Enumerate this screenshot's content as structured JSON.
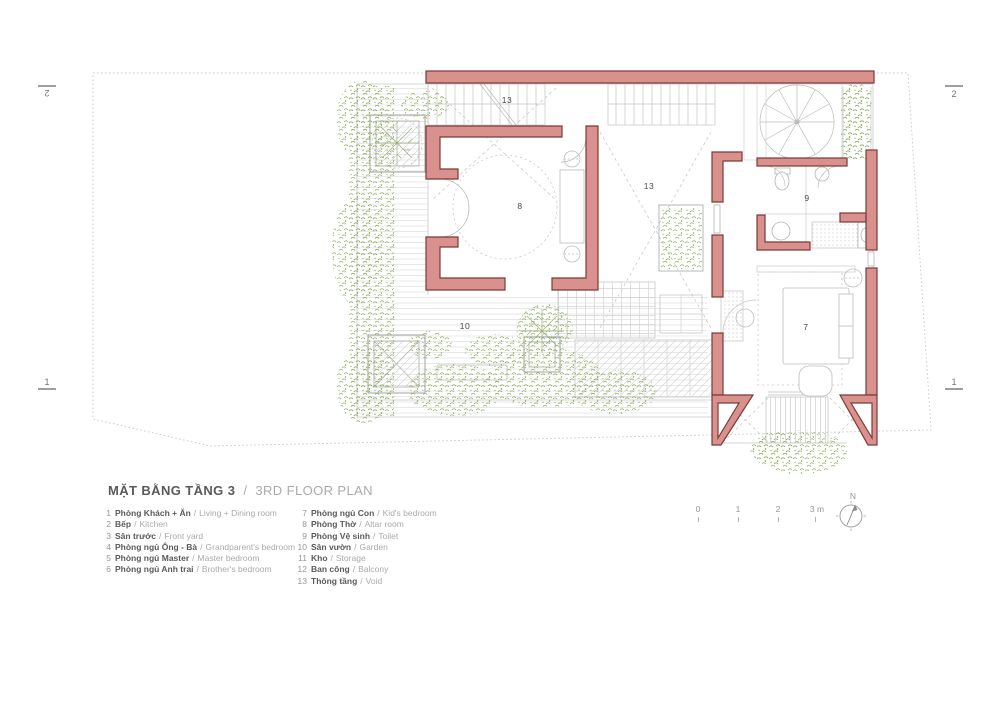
{
  "title": {
    "main": "MẶT BẰNG TẦNG 3",
    "separator": "/",
    "subtitle": "3RD FLOOR PLAN"
  },
  "legend": {
    "sep": "/",
    "left": [
      {
        "num": "1",
        "vi": "Phòng Khách + Ăn",
        "en": "Living + Dining room"
      },
      {
        "num": "2",
        "vi": "Bếp",
        "en": "Kitchen"
      },
      {
        "num": "3",
        "vi": "Sân trước",
        "en": "Front yard"
      },
      {
        "num": "4",
        "vi": "Phòng ngủ Ông - Bà",
        "en": "Grandparent's bedroom"
      },
      {
        "num": "5",
        "vi": "Phòng ngủ Master",
        "en": "Master bedroom"
      },
      {
        "num": "6",
        "vi": "Phòng ngủ Anh trai",
        "en": "Brother's bedroom"
      }
    ],
    "right": [
      {
        "num": "7",
        "vi": "Phòng ngủ Con",
        "en": "Kid's bedroom"
      },
      {
        "num": "8",
        "vi": "Phòng Thờ",
        "en": "Altar room"
      },
      {
        "num": "9",
        "vi": "Phòng Vệ sinh",
        "en": "Toilet"
      },
      {
        "num": "10",
        "vi": "Sân vườn",
        "en": "Garden"
      },
      {
        "num": "11",
        "vi": "Kho",
        "en": "Storage"
      },
      {
        "num": "12",
        "vi": "Ban công",
        "en": "Balcony"
      },
      {
        "num": "13",
        "vi": "Thông tầng",
        "en": "Void"
      }
    ]
  },
  "plan": {
    "room_labels": [
      {
        "num": "13"
      },
      {
        "num": "8"
      },
      {
        "num": "13"
      },
      {
        "num": "9"
      },
      {
        "num": "7"
      },
      {
        "num": "10"
      }
    ],
    "section_markers": [
      {
        "num": "2"
      },
      {
        "num": "1"
      },
      {
        "num": "2"
      },
      {
        "num": "1"
      }
    ]
  },
  "scale_bar": {
    "ticks": [
      "0",
      "1",
      "2",
      "3 m"
    ]
  },
  "north": {
    "label": "N"
  },
  "colors": {
    "wall_fill": "#d8918c",
    "wall_stroke": "#7b3936",
    "vegetation": "#9db86e",
    "drawing_line": "#c6c6c6",
    "title_text": "#595a5c",
    "muted_text": "#a8aaac"
  }
}
